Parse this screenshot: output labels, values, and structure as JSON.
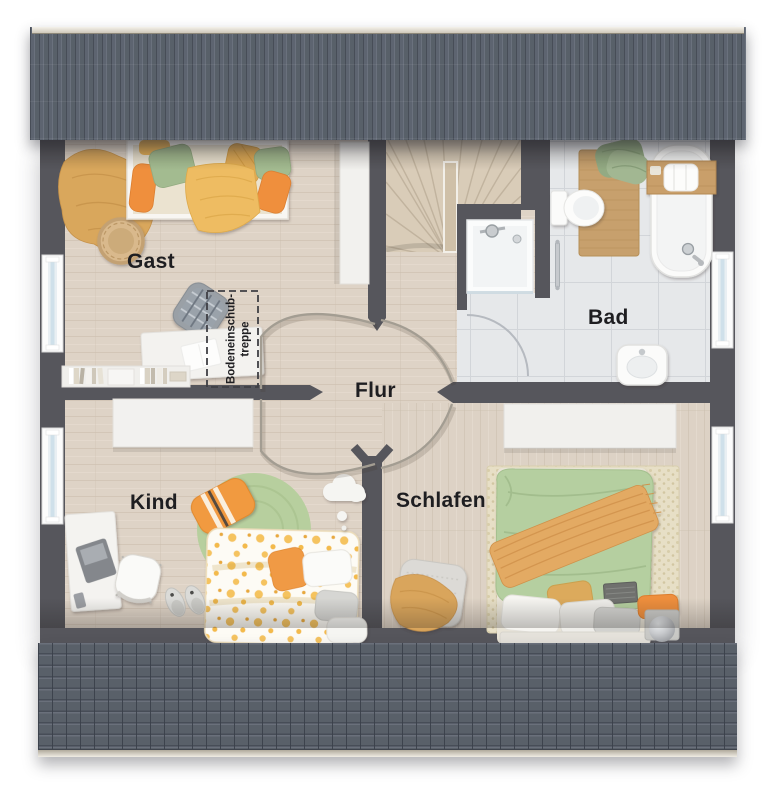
{
  "page": {
    "type": "floor-plan"
  },
  "rooms": {
    "gast": {
      "label": "Gast"
    },
    "bad": {
      "label": "Bad"
    },
    "flur": {
      "label": "Flur"
    },
    "kind": {
      "label": "Kind"
    },
    "schlafen": {
      "label": "Schlafen"
    }
  },
  "annotations": {
    "attic_hatch": {
      "line1": "Bodeneinschub-",
      "line2": "treppe"
    }
  },
  "colors": {
    "walls": "#56565c",
    "roof": "#596069",
    "roof_ridge": "#ece8df",
    "wood_floor": "#ded3c6",
    "tile_floor": "#e6e8ea",
    "stair_wood": "#d9ccb8",
    "accent_orange": "#ef8f3d",
    "accent_yellow": "#eebc62",
    "accent_green": "#a3bb90",
    "rug_green": "#b7cf9e",
    "label_text": "#1e1e21"
  }
}
